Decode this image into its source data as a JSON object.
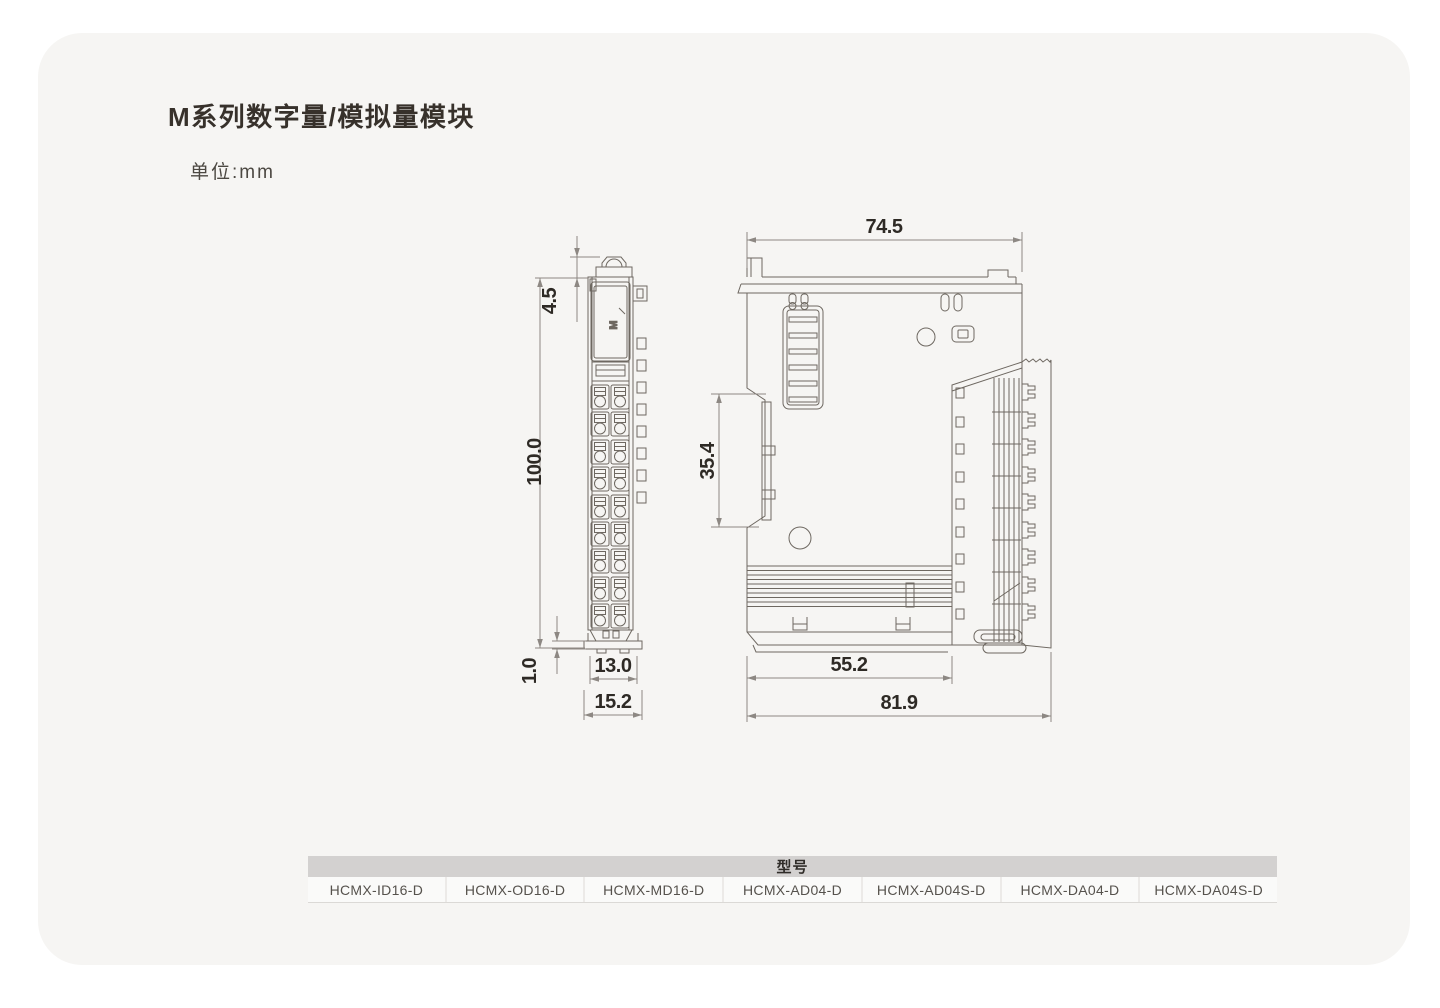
{
  "page": {
    "title": "M系列数字量/模拟量模块",
    "unit_label": "单位:mm"
  },
  "drawing": {
    "logo": "M",
    "dimensions": {
      "front_cap_height": "4.5",
      "front_height": "100.0",
      "front_foot": "1.0",
      "front_body_width": "13.0",
      "front_total_width": "15.2",
      "side_top_width": "74.5",
      "side_din_rail": "35.4",
      "side_body_depth": "55.2",
      "side_total_depth": "81.9"
    }
  },
  "table": {
    "header": "型号",
    "models": [
      "HCMX-ID16-D",
      "HCMX-OD16-D",
      "HCMX-MD16-D",
      "HCMX-AD04-D",
      "HCMX-AD04S-D",
      "HCMX-DA04-D",
      "HCMX-DA04S-D"
    ]
  }
}
